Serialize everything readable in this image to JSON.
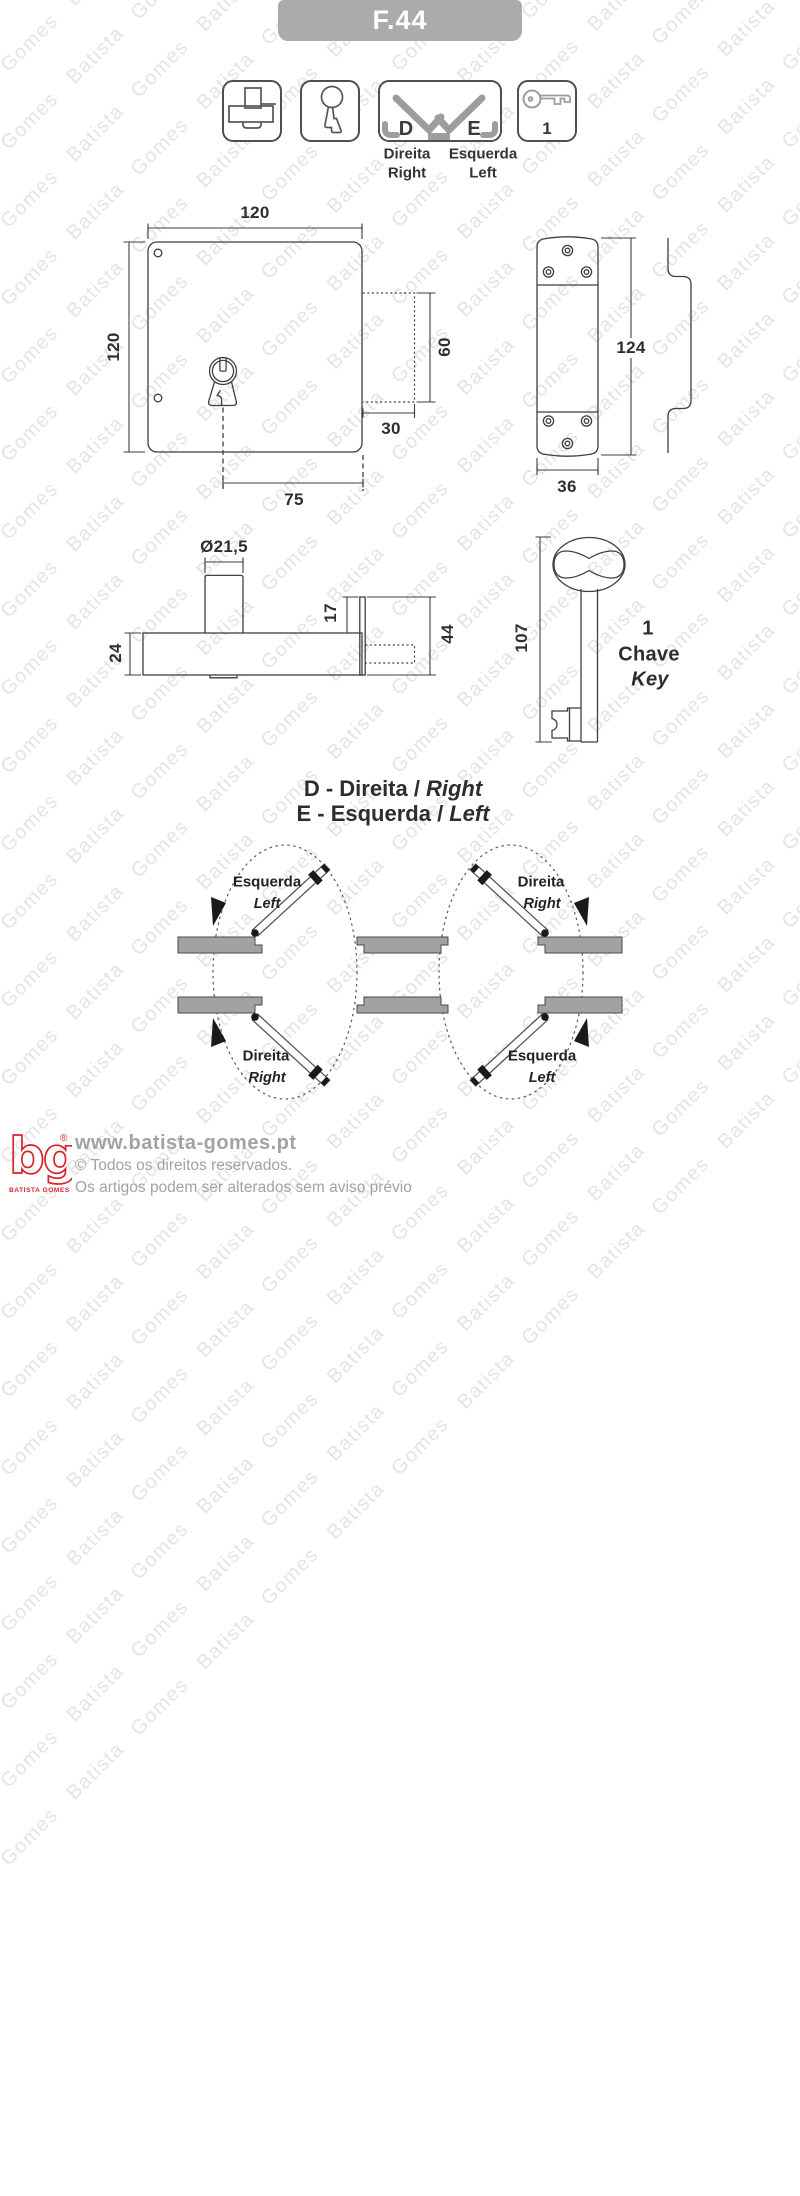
{
  "watermark": {
    "text": "Batista Gomes"
  },
  "header": {
    "product_code": "F.44"
  },
  "icon_row": {
    "d_letter": "D",
    "e_letter": "E",
    "direita": "Direita",
    "right": "Right",
    "esquerda": "Esquerda",
    "left": "Left",
    "key_count": "1"
  },
  "front_view": {
    "width_mm": "120",
    "height_mm": "120",
    "bolt_height_mm": "60",
    "bolt_depth_mm": "30",
    "keyhole_to_edge_mm": "75"
  },
  "strike_view": {
    "height_mm": "124",
    "width_mm": "36"
  },
  "side_view": {
    "cylinder_diameter_mm": "Ø21,5",
    "body_depth_mm": "24",
    "plate_above_mm": "17",
    "plate_total_mm": "44"
  },
  "key_view": {
    "length_mm": "107",
    "count": "1",
    "label_pt": "Chave",
    "label_en": "Key"
  },
  "handing": {
    "title_d_prefix": "D - Direita /",
    "title_d_italic": "Right",
    "title_e_prefix": "E - Esquerda /",
    "title_e_italic": "Left",
    "top_left": {
      "pt": "Esquerda",
      "en": "Left"
    },
    "top_right": {
      "pt": "Direita",
      "en": "Right"
    },
    "bottom_left": {
      "pt": "Direita",
      "en": "Right"
    },
    "bottom_right": {
      "pt": "Esquerda",
      "en": "Left"
    }
  },
  "footer": {
    "logo": "bg",
    "registered": "®",
    "logo_caption": "BATISTA GOMES",
    "website": "www.batista-gomes.pt",
    "rights": "© Todos os direitos reservados.",
    "notice": "Os artigos podem ser alterados sem aviso prévio"
  },
  "colors": {
    "header_gray": "#ababab",
    "line_dark": "#3f3f3f",
    "accent_gray": "#9d9d9d",
    "wall_gray": "#a2a2a2",
    "brand_red": "#d8232a",
    "watermark_gray": "#e4e4e4",
    "footer_text_gray": "#a2a2a2"
  }
}
